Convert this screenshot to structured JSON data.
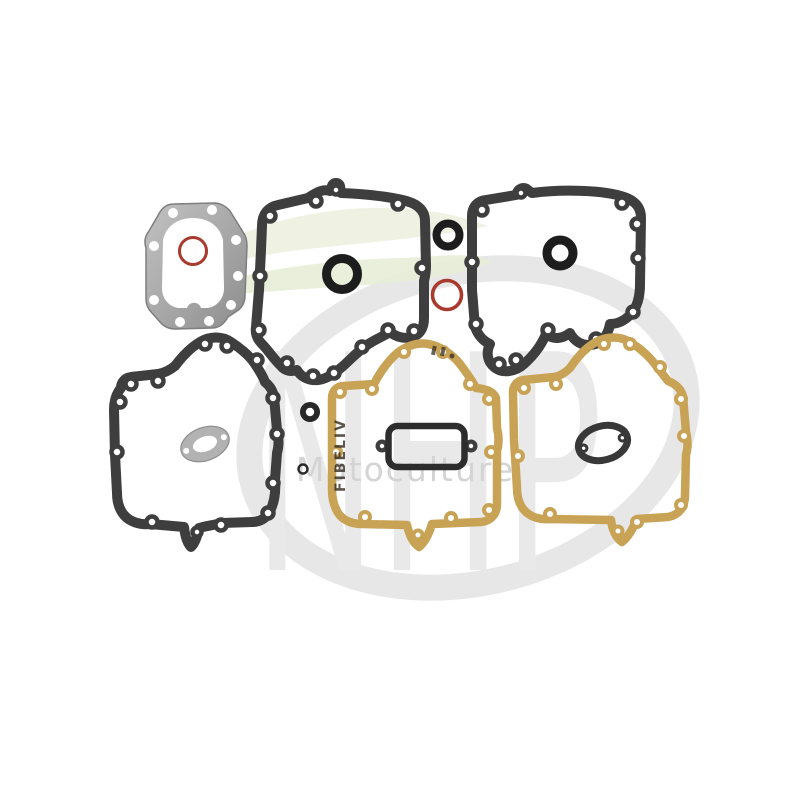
{
  "page": {
    "kind": "product-photo",
    "subject": "engine gasket set on white background"
  },
  "watermark": {
    "brand_letters": "NHP",
    "subtitle": "Motoculture"
  },
  "stamp": {
    "text": "FIBELIV"
  },
  "palette": {
    "bg": "#ffffff",
    "charcoal": "#3e3e3e",
    "seal": "#1d1d1d",
    "tan": "#c8a355",
    "red": "#a83a2e",
    "metal_light": "#bfbfbf",
    "metal_dark": "#8d8d8d",
    "oval_gray": "#b2b2b2",
    "grommet": "#282828",
    "wm_letters": "#e9e9e9",
    "wm_orbit": "#e7e7e7",
    "wm_subtitle": "#d4d4d4",
    "leaf_a": "#eef1e1",
    "leaf_b": "#e9eed8",
    "stamp": "#332b20"
  },
  "parts": [
    {
      "id": "cylinder-head-gasket",
      "material": "metal-gray"
    },
    {
      "id": "crankcase-gasket-upper-left",
      "material": "charcoal-fiber"
    },
    {
      "id": "crankcase-gasket-upper-right",
      "material": "charcoal-fiber"
    },
    {
      "id": "crankcase-gasket-lower-left",
      "material": "charcoal-fiber"
    },
    {
      "id": "base-gasket-lower-middle",
      "material": "tan-paper"
    },
    {
      "id": "base-gasket-lower-right",
      "material": "tan-paper"
    },
    {
      "id": "breather-gasket",
      "material": "charcoal-fiber"
    },
    {
      "id": "oil-seal-left",
      "material": "rubber"
    },
    {
      "id": "oil-seal-right",
      "material": "rubber"
    },
    {
      "id": "o-ring-black",
      "material": "rubber"
    },
    {
      "id": "o-ring-red-large",
      "material": "rubber"
    },
    {
      "id": "o-ring-red-small",
      "material": "rubber"
    },
    {
      "id": "grommet-small",
      "material": "rubber"
    },
    {
      "id": "o-ring-tiny",
      "material": "rubber"
    },
    {
      "id": "exhaust-flange-gasket-gray",
      "material": "metal-gray"
    },
    {
      "id": "carb-flange-gasket-dark",
      "material": "charcoal-fiber"
    }
  ]
}
